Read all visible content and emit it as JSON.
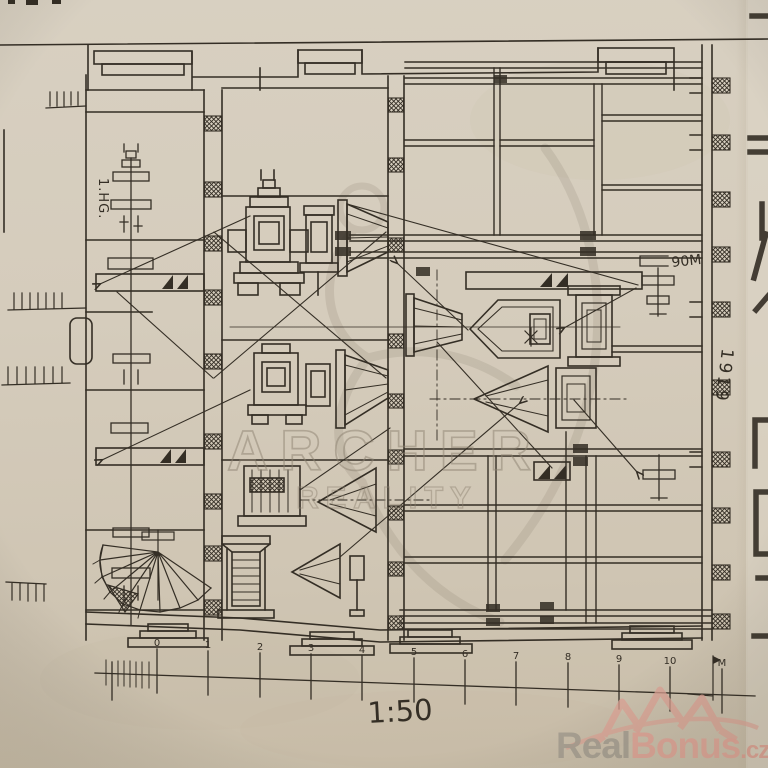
{
  "labels": {
    "floor": "1.HG.",
    "dimension": "90M",
    "year": "1919",
    "scale": "1:50"
  },
  "ruler": {
    "ticks": [
      "0",
      "1",
      "2",
      "3",
      "4",
      "5",
      "6",
      "7",
      "8",
      "9",
      "10"
    ],
    "end": "M"
  },
  "watermark": {
    "line1": "ARCHER",
    "line2": "REALITY"
  },
  "brand": {
    "name_gray": "Real",
    "name_red": "Bonus",
    "tld": ".cz"
  },
  "colors": {
    "paper": "#d5ccbc",
    "ink": "#342e25",
    "watermark": "#8d8271",
    "brand_gray": "#a39c8f",
    "brand_red": "#e0a295"
  }
}
